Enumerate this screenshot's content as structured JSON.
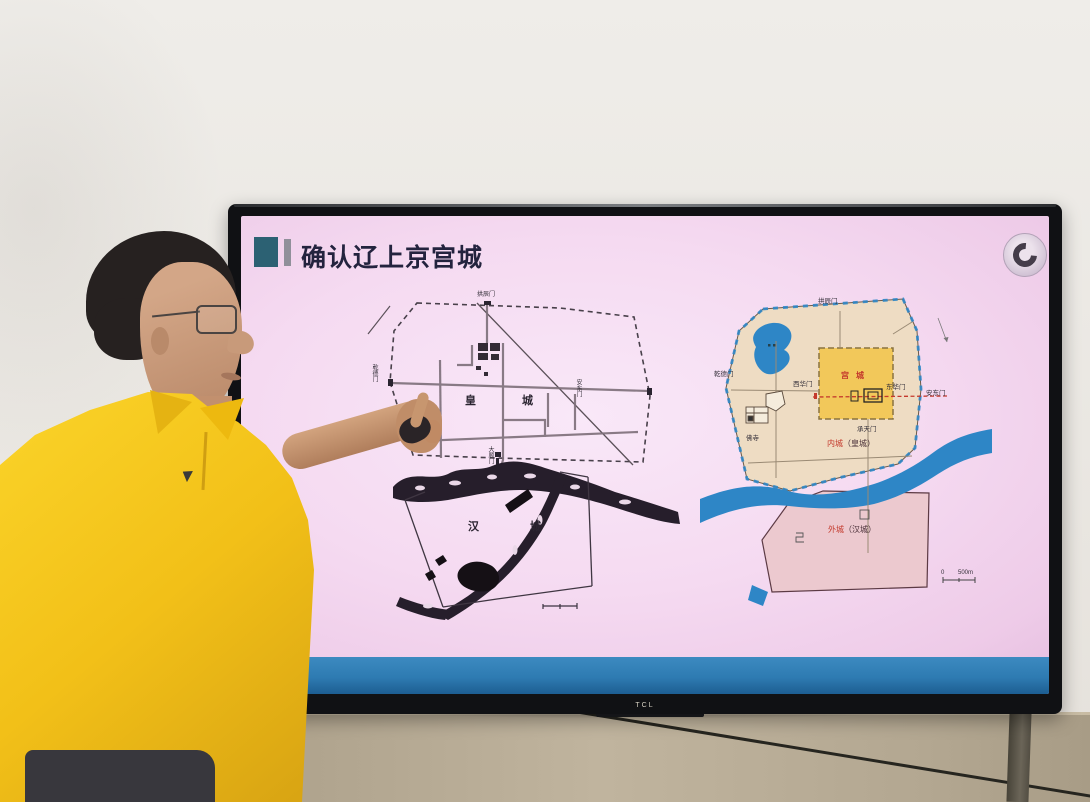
{
  "tv": {
    "brand": "TCL"
  },
  "slide": {
    "title": "确认辽上京宫城",
    "logo": {
      "name": "institute-seal",
      "shape": "circular-emblem"
    },
    "colors": {
      "background": "#f2d4ec",
      "footer_band": "#2e7bb2",
      "accent_square": "#2c6173",
      "accent_bar": "#90909a",
      "title_text": "#23233e"
    }
  },
  "left_map": {
    "labels": {
      "north_gate": "拱辰门",
      "west_gate": "乾德门",
      "east_gate": "安东门",
      "south_gate": "大顺门",
      "imperial_city": "皇城",
      "han_city": "汉城"
    }
  },
  "right_map": {
    "labels": {
      "north_gate": "拱辰门",
      "west_gate": "乾德门",
      "east_gate": "安东门",
      "palace_west_gate": "西华门",
      "palace_east_gate": "东华门",
      "palace_south_gate": "承天门",
      "palace_city": "宫城",
      "temple": "佛寺",
      "inner_city": "内城",
      "inner_city_paren": "（皇城）",
      "outer_city": "外城",
      "outer_city_paren": "（汉城）",
      "scale_zero": "0",
      "scale_label": "500m"
    },
    "colors": {
      "inner_city_fill": "#eedcc3",
      "palace_fill": "#f2c85a",
      "outer_city_fill": "#ecc9cf",
      "water": "#2e86c6",
      "red_label": "#c4392c"
    }
  }
}
